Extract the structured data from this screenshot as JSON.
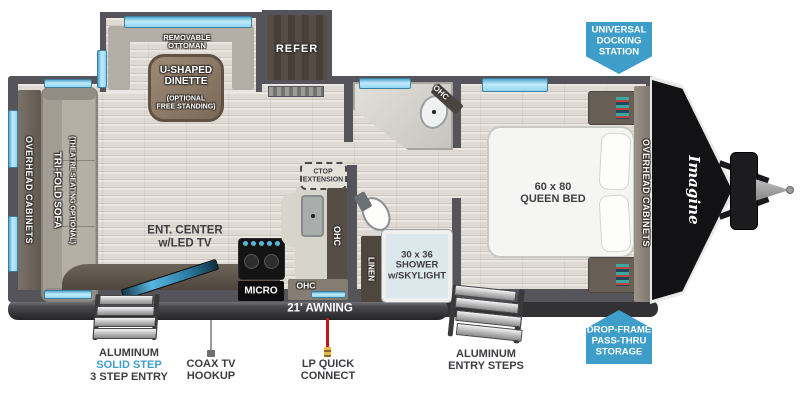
{
  "branding": {
    "logo": "Imagine"
  },
  "badges": {
    "docking": "UNIVERSAL\nDOCKING\nSTATION",
    "storage": "DROP-FRAME\nPASS-THRU\nSTORAGE"
  },
  "living_area": {
    "overhead_cabinets": "OVERHEAD CABINETS",
    "sofa": "TRI-FOLD SOFA",
    "sofa_option": "(THEATRE SEATING OPTIONAL)",
    "ottoman": "REMOVABLE\nOTTOMAN",
    "dinette": "U-SHAPED\nDINETTE",
    "dinette_option": "(OPTIONAL\nFREE STANDING)",
    "refrigerator": "REFER",
    "ent_center": "ENT. CENTER\nw/LED TV",
    "microwave": "MICRO",
    "countertop_extension": "CTOP\nEXTENSION",
    "ohc": "OHC"
  },
  "bathroom": {
    "ohc": "OHC",
    "linen": "LINEN",
    "shower": "30 x 36\nSHOWER\nw/SKYLIGHT"
  },
  "bedroom": {
    "bed": "60 x 80\nQUEEN BED",
    "overhead_cabinets": "OVERHEAD CABINETS"
  },
  "exterior": {
    "awning": "21' AWNING",
    "solid_step_line1": "ALUMINUM",
    "solid_step_line2": "SOLID STEP",
    "solid_step_line3": "3 STEP ENTRY",
    "coax": "COAX TV\nHOOKUP",
    "lp": "LP QUICK\nCONNECT",
    "entry_steps": "ALUMINUM\nENTRY STEPS"
  },
  "colors": {
    "badge_blue": "#3f9ec9",
    "window_cyan": "#8fd6f2",
    "wall_gray": "#55545a",
    "step_highlight_blue": "#3f9ec9"
  }
}
